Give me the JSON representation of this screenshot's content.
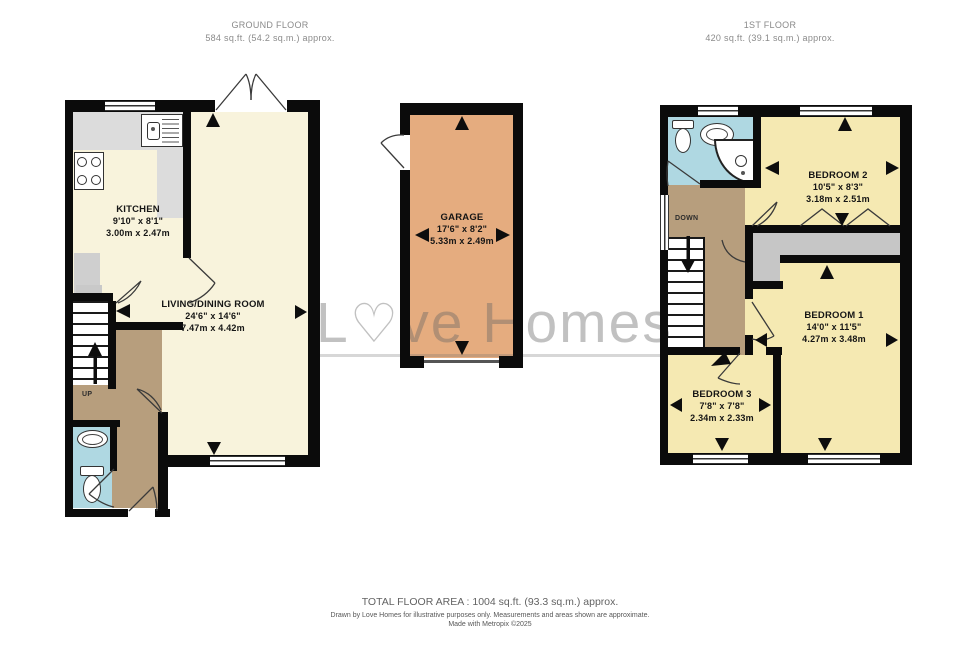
{
  "headers": {
    "ground": {
      "title": "GROUND FLOOR",
      "area": "584 sq.ft. (54.2 sq.m.) approx."
    },
    "first": {
      "title": "1ST FLOOR",
      "area": "420 sq.ft. (39.1 sq.m.) approx."
    }
  },
  "rooms": {
    "kitchen": {
      "name": "KITCHEN",
      "imperial": "9'10\"  x 8'1\"",
      "metric": "3.00m  x 2.47m"
    },
    "living": {
      "name": "LIVING/DINING ROOM",
      "imperial": "24'6\"  x 14'6\"",
      "metric": "7.47m  x 4.42m"
    },
    "garage": {
      "name": "GARAGE",
      "imperial": "17'6\"  x 8'2\"",
      "metric": "5.33m  x 2.49m"
    },
    "bedroom1": {
      "name": "BEDROOM 1",
      "imperial": "14'0\"  x 11'5\"",
      "metric": "4.27m  x 3.48m"
    },
    "bedroom2": {
      "name": "BEDROOM 2",
      "imperial": "10'5\"  x 8'3\"",
      "metric": "3.18m  x 2.51m"
    },
    "bedroom3": {
      "name": "BEDROOM 3",
      "imperial": "7'8\"  x 7'8\"",
      "metric": "2.34m  x 2.33m"
    }
  },
  "stairs": {
    "up": "UP",
    "down": "DOWN"
  },
  "watermark": {
    "first": "L",
    "heart": "♡",
    "rest": "ve Homes"
  },
  "footer": {
    "total": "TOTAL FLOOR AREA : 1004 sq.ft. (93.3 sq.m.) approx.",
    "disclaimer": "Drawn by Love Homes for illustrative purposes only. Measurements and areas shown are approximate.",
    "credit": "Made with Metropix ©2025"
  },
  "colors": {
    "wall": "#0b0b0b",
    "ground_room": "#F8F3DC",
    "bedroom": "#F5E9B2",
    "garage": "#E5AC7F",
    "hall": "#B79E7D",
    "bathroom": "#AFD8E2",
    "counter": "#DCDCDC",
    "wardrobe": "#C6C6C6"
  }
}
